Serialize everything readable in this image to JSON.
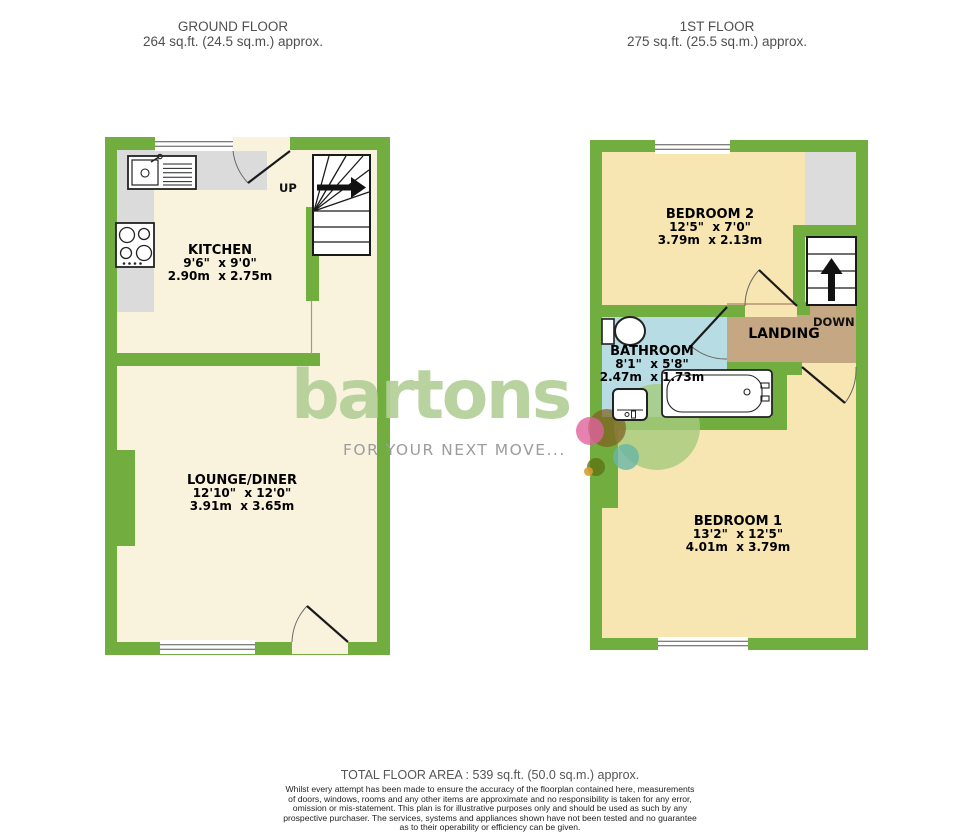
{
  "header": {
    "ground": {
      "title": "GROUND FLOOR",
      "area": "264 sq.ft. (24.5 sq.m.) approx."
    },
    "first": {
      "title": "1ST FLOOR",
      "area": "275 sq.ft. (25.5 sq.m.) approx."
    }
  },
  "rooms": {
    "kitchen": {
      "name": "KITCHEN",
      "imperial": "9'6\"  x 9'0\"",
      "metric": "2.90m  x 2.75m"
    },
    "lounge": {
      "name": "LOUNGE/DINER",
      "imperial": "12'10\"  x 12'0\"",
      "metric": "3.91m  x 3.65m"
    },
    "bedroom2": {
      "name": "BEDROOM 2",
      "imperial": "12'5\"  x 7'0\"",
      "metric": "3.79m  x 2.13m"
    },
    "bathroom": {
      "name": "BATHROOM",
      "imperial": "8'1\"  x 5'8\"",
      "metric": "2.47m  x 1.73m"
    },
    "bedroom1": {
      "name": "BEDROOM 1",
      "imperial": "13'2\"  x 12'5\"",
      "metric": "4.01m  x 3.79m"
    }
  },
  "labels": {
    "landing": "LANDING",
    "up": "UP",
    "down": "DOWN"
  },
  "logo": {
    "brand": "bartons",
    "tagline": "FOR YOUR NEXT MOVE..."
  },
  "footer": {
    "total": "TOTAL FLOOR AREA : 539 sq.ft. (50.0 sq.m.) approx.",
    "disclaimer_lines": [
      "Whilst every attempt has been made to ensure the accuracy of the floorplan contained here, measurements",
      "of doors, windows, rooms and any other items are approximate and no responsibility is taken for any error,",
      "omission or mis-statement. This plan is for illustrative purposes only and should be used as such by any",
      "prospective purchaser. The services, systems and appliances shown have not been tested and no guarantee",
      "as to their operability or efficiency can be given."
    ],
    "credit": "Made with Metropix ©2024"
  },
  "colors": {
    "wall_green": "#72AE3F",
    "ground_floor_fill": "#F9F3DE",
    "first_floor_fill": "#F7E5B2",
    "bathroom_fill": "#B8DCE4",
    "landing_fill": "#C5A783",
    "counter_gray": "#DBDBDB",
    "logo_green": "#B4D098",
    "tagline_gray": "#9C9C9C"
  }
}
